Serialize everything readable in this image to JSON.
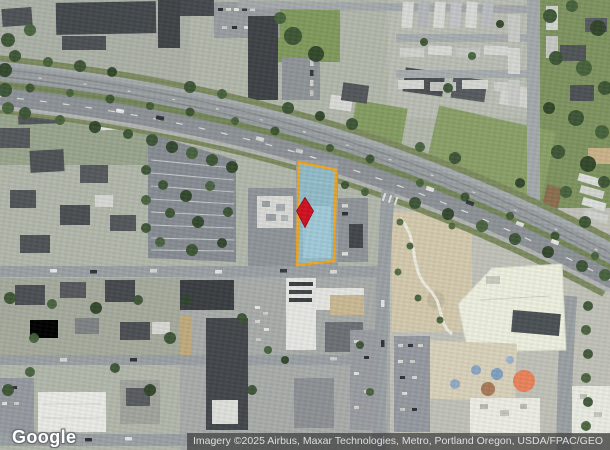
{
  "map": {
    "imagery_type": "satellite",
    "location_hint": "Portland Oregon area parcel view"
  },
  "parcel": {
    "points": "299,162 336,170 334,261 297,265",
    "fill": "rgba(139,201,221,0.62)",
    "stroke": "#f0a41d",
    "stroke_width": "2.6"
  },
  "marker": {
    "path": "M305 197.5 L313.5 211 L305 227.5 L296.5 211 Z",
    "fill": "#d01020",
    "stroke": "#8e0b14"
  },
  "watermark": {
    "text": "Google"
  },
  "attribution": {
    "text": "Imagery ©2025 Airbus, Maxar Technologies, Metro, Portland Oregon, USDA/FPAC/GEO"
  }
}
